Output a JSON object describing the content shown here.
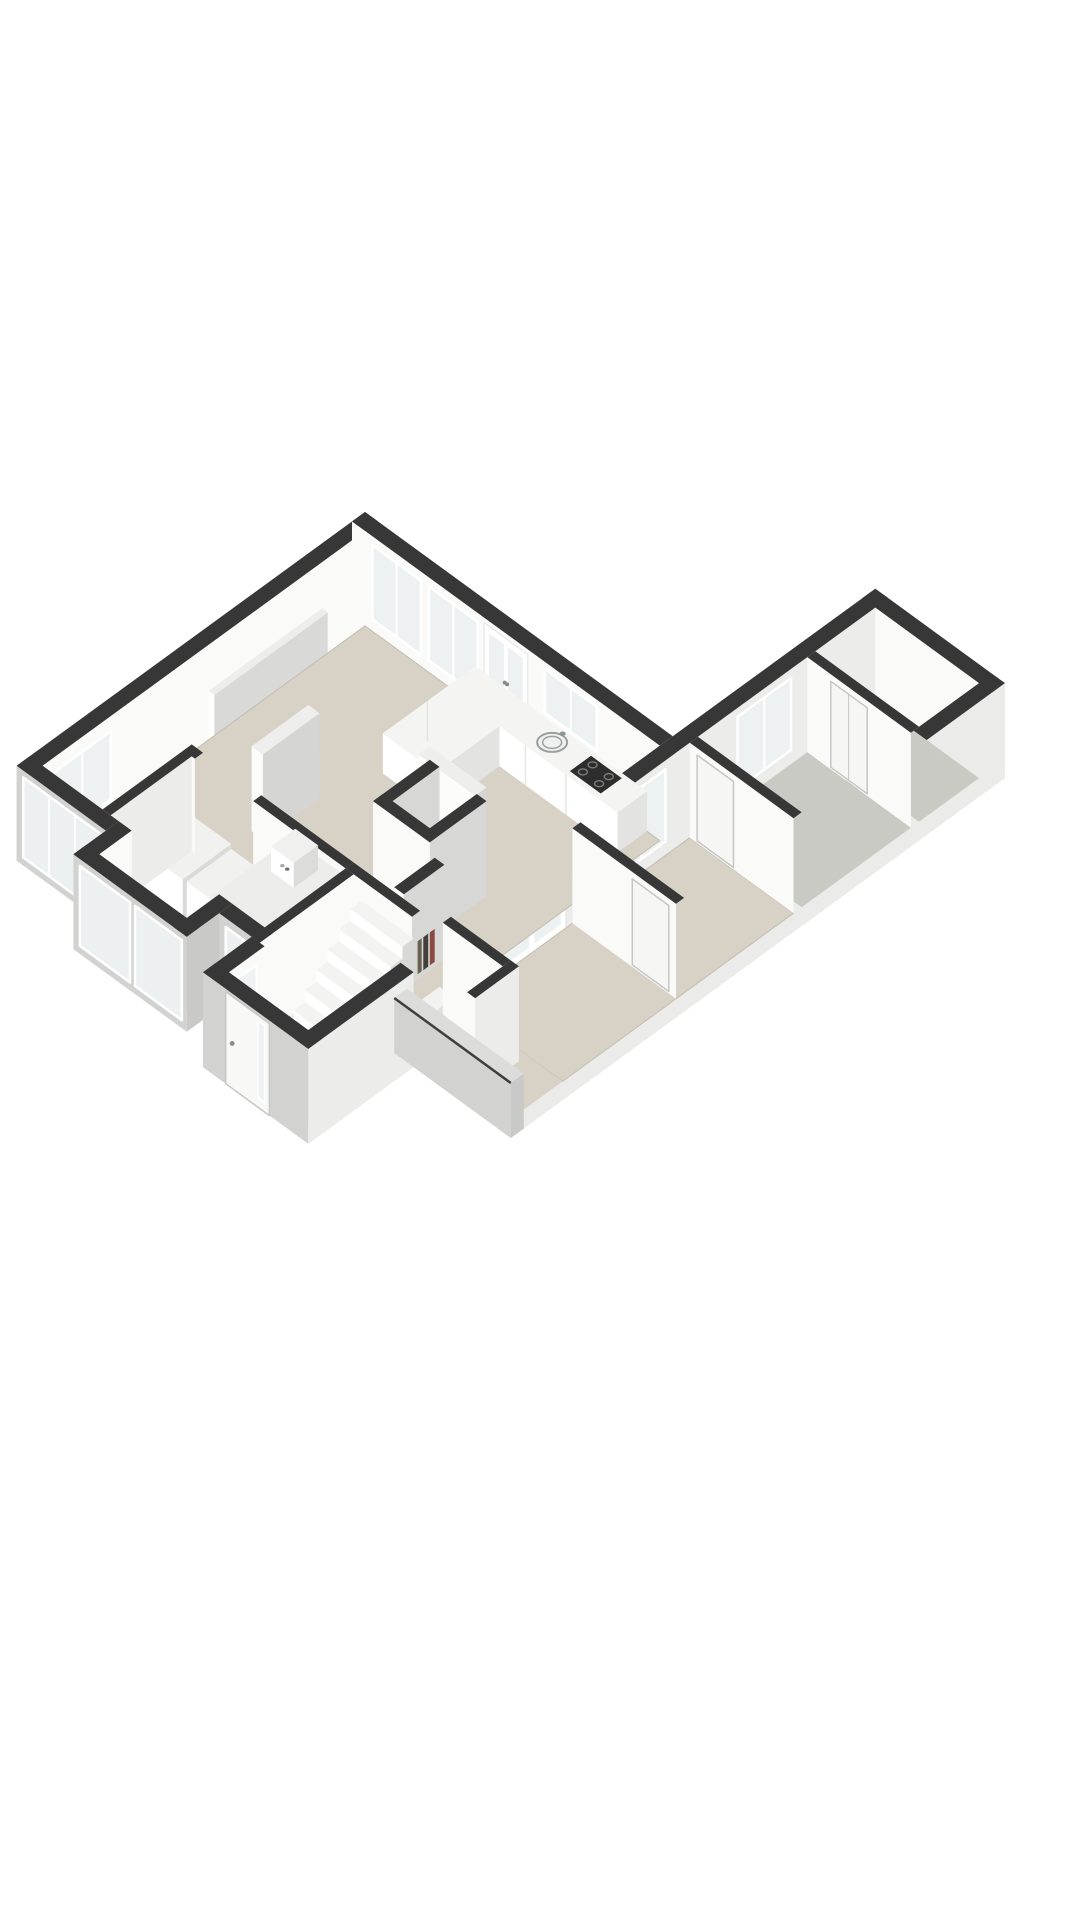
{
  "canvas": {
    "width": 1080,
    "height": 1920,
    "background": "#ffffff"
  },
  "floorplan": {
    "view": "3d-isometric-floorplan",
    "style": "rendered-dollhouse",
    "colors": {
      "background": "#ffffff",
      "wall_cap": "#373737",
      "cut_wall_top": "#dcdcda",
      "cut_wall_edge": "#3f3f3f",
      "wall_white": "#fafaf9",
      "wall_light": "#ececea",
      "wall_shaded": "#d7d7d5",
      "wall_gray": "#c9c9c7",
      "wall_outer": "#d2d2d0",
      "floor_beige": "#d8d1c5",
      "floor_beige_edge": "#c4bdb1",
      "floor_gray": "#c9cac4",
      "floor_hall": "#eae9e6",
      "glass": "#eef1f1",
      "frame_white": "#ffffff",
      "counter_top": "#f4f4f3",
      "counter_front": "#ffffff",
      "counter_side": "#e3e3e1",
      "slab_top": "#eeeeec",
      "slab_front": "#fcfcfb",
      "slab_side": "#d5d5d3",
      "door_leaf": "#f6f6f5",
      "door_line": "#c6c6c4",
      "cooktop": "#2d2d2d",
      "burner": "#7a7a7a",
      "sink_fill": "#eff1f0",
      "sink_line": "#9aa0a0",
      "fixture_white": "#fdfdfd",
      "fixture_line": "#c8c8c6",
      "duct_inner": "#b9b7b2",
      "book_red": "#8a4a42",
      "book_dark": "#43403c",
      "book_tan": "#6b6256",
      "handle": "#8a8a88"
    },
    "rooms": [
      {
        "name": "living-room",
        "floor": "beige"
      },
      {
        "name": "open-kitchen",
        "floor": "beige"
      },
      {
        "name": "utility-room",
        "floor": "beige"
      },
      {
        "name": "entrance-hall-stairs",
        "floor": "light"
      },
      {
        "name": "toilet",
        "floor": "light"
      },
      {
        "name": "wing-corridor",
        "floor": "beige"
      },
      {
        "name": "bedroom",
        "floor": "beige"
      },
      {
        "name": "bedroom-2",
        "floor": "gray"
      },
      {
        "name": "storage-room",
        "floor": "gray"
      }
    ],
    "fixtures": [
      "kitchen-counter-l-shape",
      "kitchen-sink",
      "gas-cooktop-4-burners",
      "chimney-duct",
      "shelf-niche-with-books",
      "staircase",
      "front-door",
      "washing-machine",
      "laundry-unit",
      "built-in-closet-double-doors",
      "boiler-unit",
      "toilet-bowl",
      "radiator",
      "wardrobe-panel",
      "wardrobe-panel-2"
    ],
    "openings": [
      "ne-facade-window-1",
      "ne-facade-window-2",
      "ne-facade-glazed-door",
      "kitchen-window",
      "nw-facade-window",
      "sw-facade-large-window",
      "bay-front-windows",
      "sw-facade-window-2",
      "entrance-side-window",
      "wing-west-window-bedroom",
      "wing-west-window-bedroom-2",
      "wing-glazed-double-doors",
      "interior-door-storage",
      "interior-door-bedroom-2",
      "interior-door-bedroom"
    ],
    "counts": {
      "staircase_steps": 6,
      "cooktop_burners": 4,
      "bay_window_panes": 2
    }
  }
}
